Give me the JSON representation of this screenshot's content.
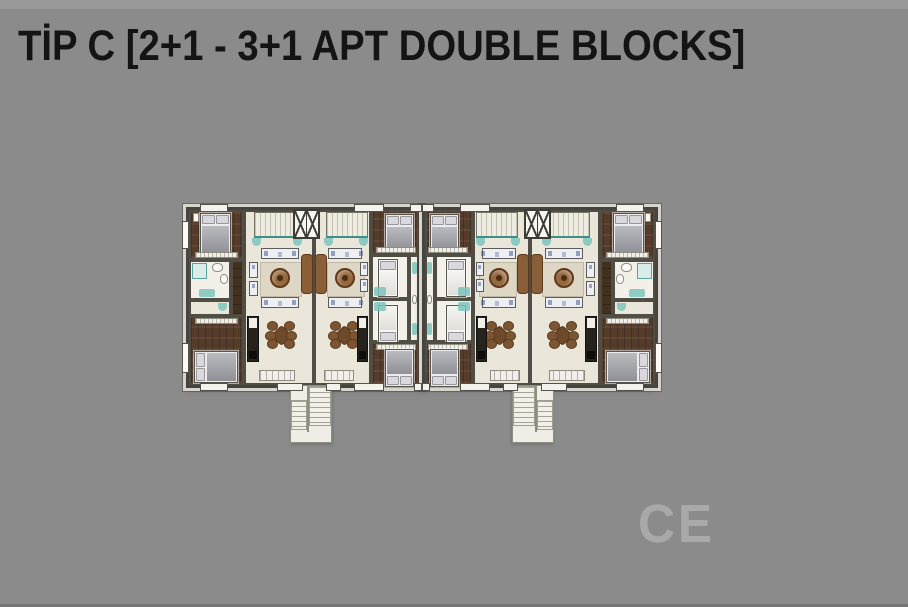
{
  "title": "TİP C [2+1 - 3+1 APT DOUBLE BLOCKS]",
  "watermark": "CE",
  "floor_plan": {
    "label": "Tip C double block floor plan",
    "block_layout": "two mirrored halves, four apartment units",
    "unit_types": [
      "2+1",
      "3+1"
    ],
    "features": [
      "balconies",
      "elevator-shafts",
      "exterior-staircases",
      "living-rooms",
      "bedrooms",
      "bathrooms",
      "kitchens"
    ]
  },
  "colors": {
    "background": "#8b8b8b",
    "title_text": "#141414",
    "floor_cream": "#eae6da",
    "wood_floor": "#553c2a",
    "teal_accent": "#7cc4bc",
    "wall_dark": "#46443e",
    "wall_light": "#d8d6cc",
    "furniture_brown": "#7c5533",
    "stair_white": "#efede6"
  }
}
